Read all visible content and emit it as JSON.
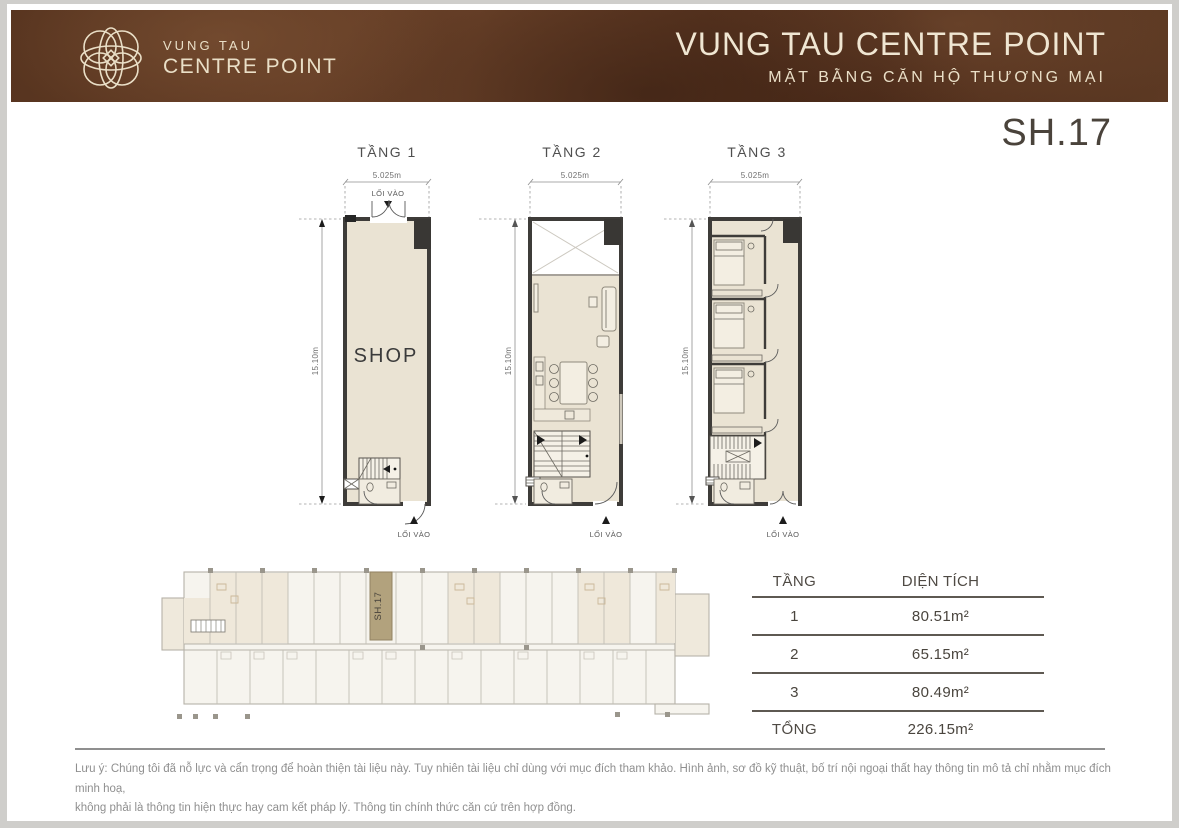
{
  "header": {
    "logo_line1": "VUNG TAU",
    "logo_line2": "CENTRE POINT",
    "title": "VUNG TAU CENTRE POINT",
    "subtitle": "MẶT BẰNG CĂN HỘ THƯƠNG MẠI"
  },
  "unit_code": "SH.17",
  "floor_plans": {
    "shared": {
      "width_dim": "5.025m",
      "height_dim": "15.10m",
      "entrance": "LỐI VÀO"
    },
    "plans": [
      {
        "title": "TẦNG 1",
        "room_label": "SHOP"
      },
      {
        "title": "TẦNG 2"
      },
      {
        "title": "TẦNG 3"
      }
    ]
  },
  "site_plan": {
    "highlight_label": "SH.17"
  },
  "area_table": {
    "headers": {
      "floor": "TẦNG",
      "area": "DIỆN TÍCH"
    },
    "rows": [
      {
        "floor": "1",
        "area": "80.51m²"
      },
      {
        "floor": "2",
        "area": "65.15m²"
      },
      {
        "floor": "3",
        "area": "80.49m²"
      }
    ],
    "total": {
      "label": "TỔNG",
      "area": "226.15m²"
    }
  },
  "footnote": {
    "line1": "Lưu ý: Chúng tôi đã nỗ lực và cẩn trọng để hoàn thiện tài liệu này. Tuy nhiên tài liệu chỉ dùng với mục đích tham khảo. Hình ảnh, sơ đồ kỹ thuật, bố trí nội ngoại thất hay thông tin mô tả chỉ nhằm mục đích minh hoạ,",
    "line2": "không phải là thông tin hiện thực hay cam kết pháp lý. Thông tin chính thức căn cứ trên hợp đồng."
  },
  "colors": {
    "header_brown": "#5c3923",
    "logo_cream": "#eadfc7",
    "plan_fill": "#eae3d3",
    "wall": "#3e3c39",
    "site_highlight": "#b2a27d",
    "text_dark": "#4a433b",
    "note_gray": "#8f8f8f"
  }
}
